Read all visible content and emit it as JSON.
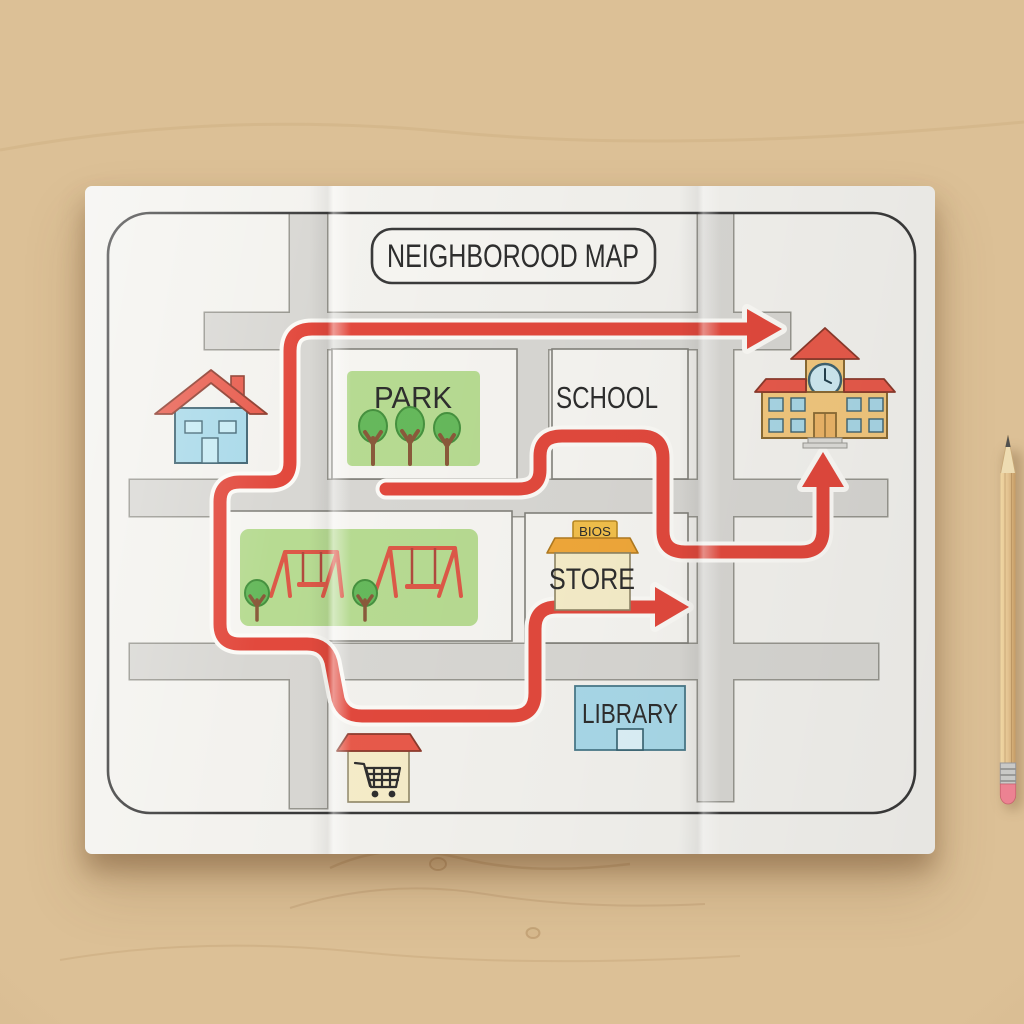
{
  "map": {
    "title": "NEIGHBOROOD MAP",
    "park_label": "PARK",
    "school_label": "SCHOOL",
    "store_label": "STORE",
    "store_sign": "BIOS",
    "library_label": "LIBRARY"
  },
  "icons": {
    "house": "house-icon",
    "school_building": "school-building-icon",
    "clock": "clock-icon",
    "store_kiosk": "store-kiosk-icon",
    "library_building": "library-building-icon",
    "cart_kiosk": "shopping-cart-kiosk-icon",
    "tree": "tree-icon",
    "swing_set": "swing-set-icon",
    "route_arrow": "route-arrow-icon",
    "pencil": "pencil-icon"
  },
  "colors": {
    "route_red": "#e2493d",
    "roof_red": "#e85a4b",
    "swing_red": "#dd5948",
    "road_gray": "#d8d7d3",
    "paper_white": "#f3f2ee",
    "block_white": "#f6f5f1",
    "park_green": "#b7db92",
    "tree_green": "#66b95c",
    "house_blue": "#a8d9e9",
    "library_blue": "#a9d9e9",
    "school_tan": "#f3c87e",
    "store_cream": "#f6edc9",
    "awning_orange": "#f0a83a",
    "sign_yellow": "#f2c04c",
    "pencil_wood": "#e3c391",
    "eraser_pink": "#ec8292",
    "ink_dark": "#2e2e2e"
  }
}
